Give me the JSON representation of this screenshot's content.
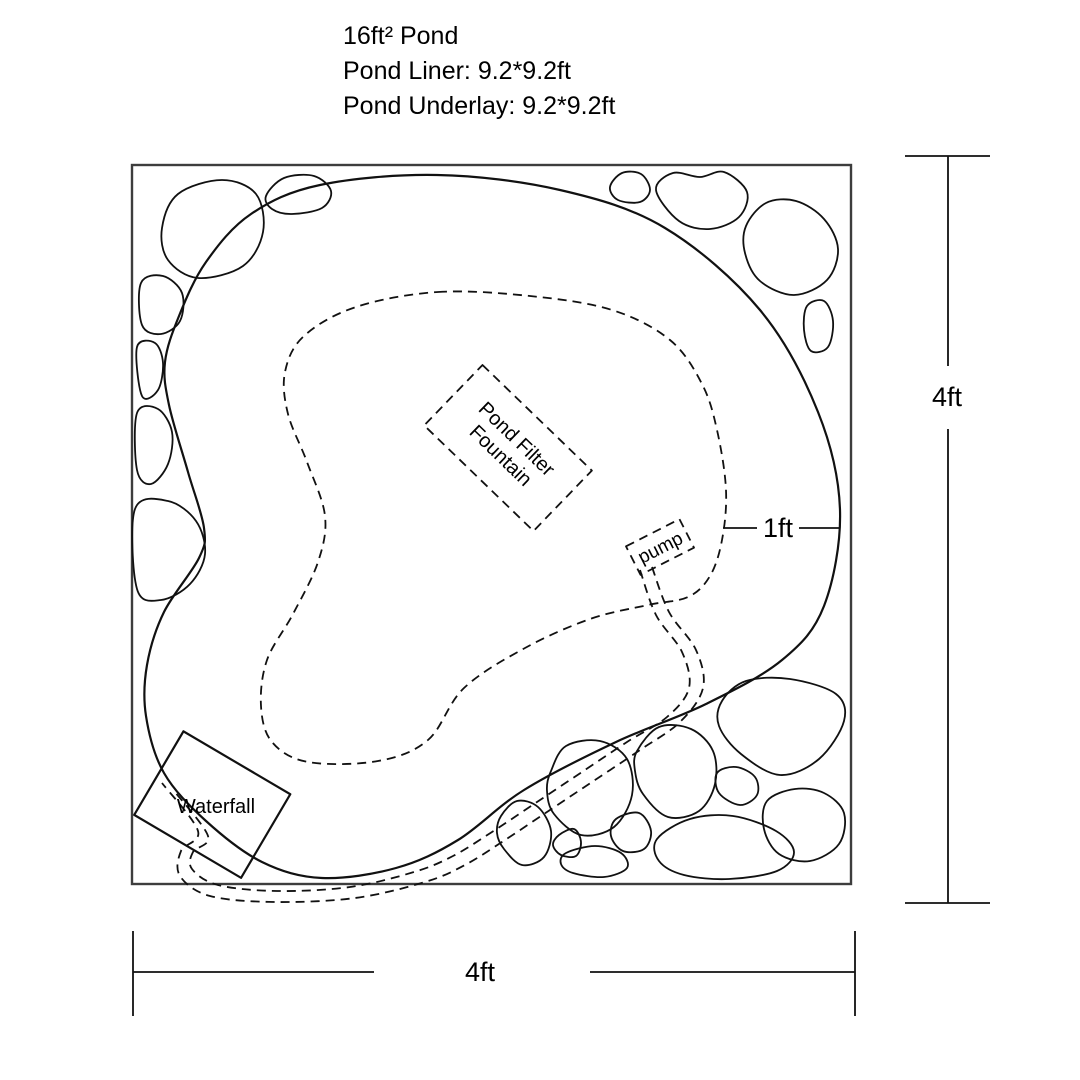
{
  "title": {
    "line1": "16ft² Pond",
    "line2": "Pond Liner: 9.2*9.2ft",
    "line3": "Pond Underlay: 9.2*9.2ft"
  },
  "labels": {
    "filter_line1": "Pond Filter",
    "filter_line2": "Fountain",
    "pump": "pump",
    "waterfall": "Waterfall"
  },
  "dimensions": {
    "width": "4ft",
    "height": "4ft",
    "shelf_offset": "1ft"
  },
  "colors": {
    "line": "#111111",
    "boundary": "#3d3d3d",
    "background": "#ffffff"
  }
}
